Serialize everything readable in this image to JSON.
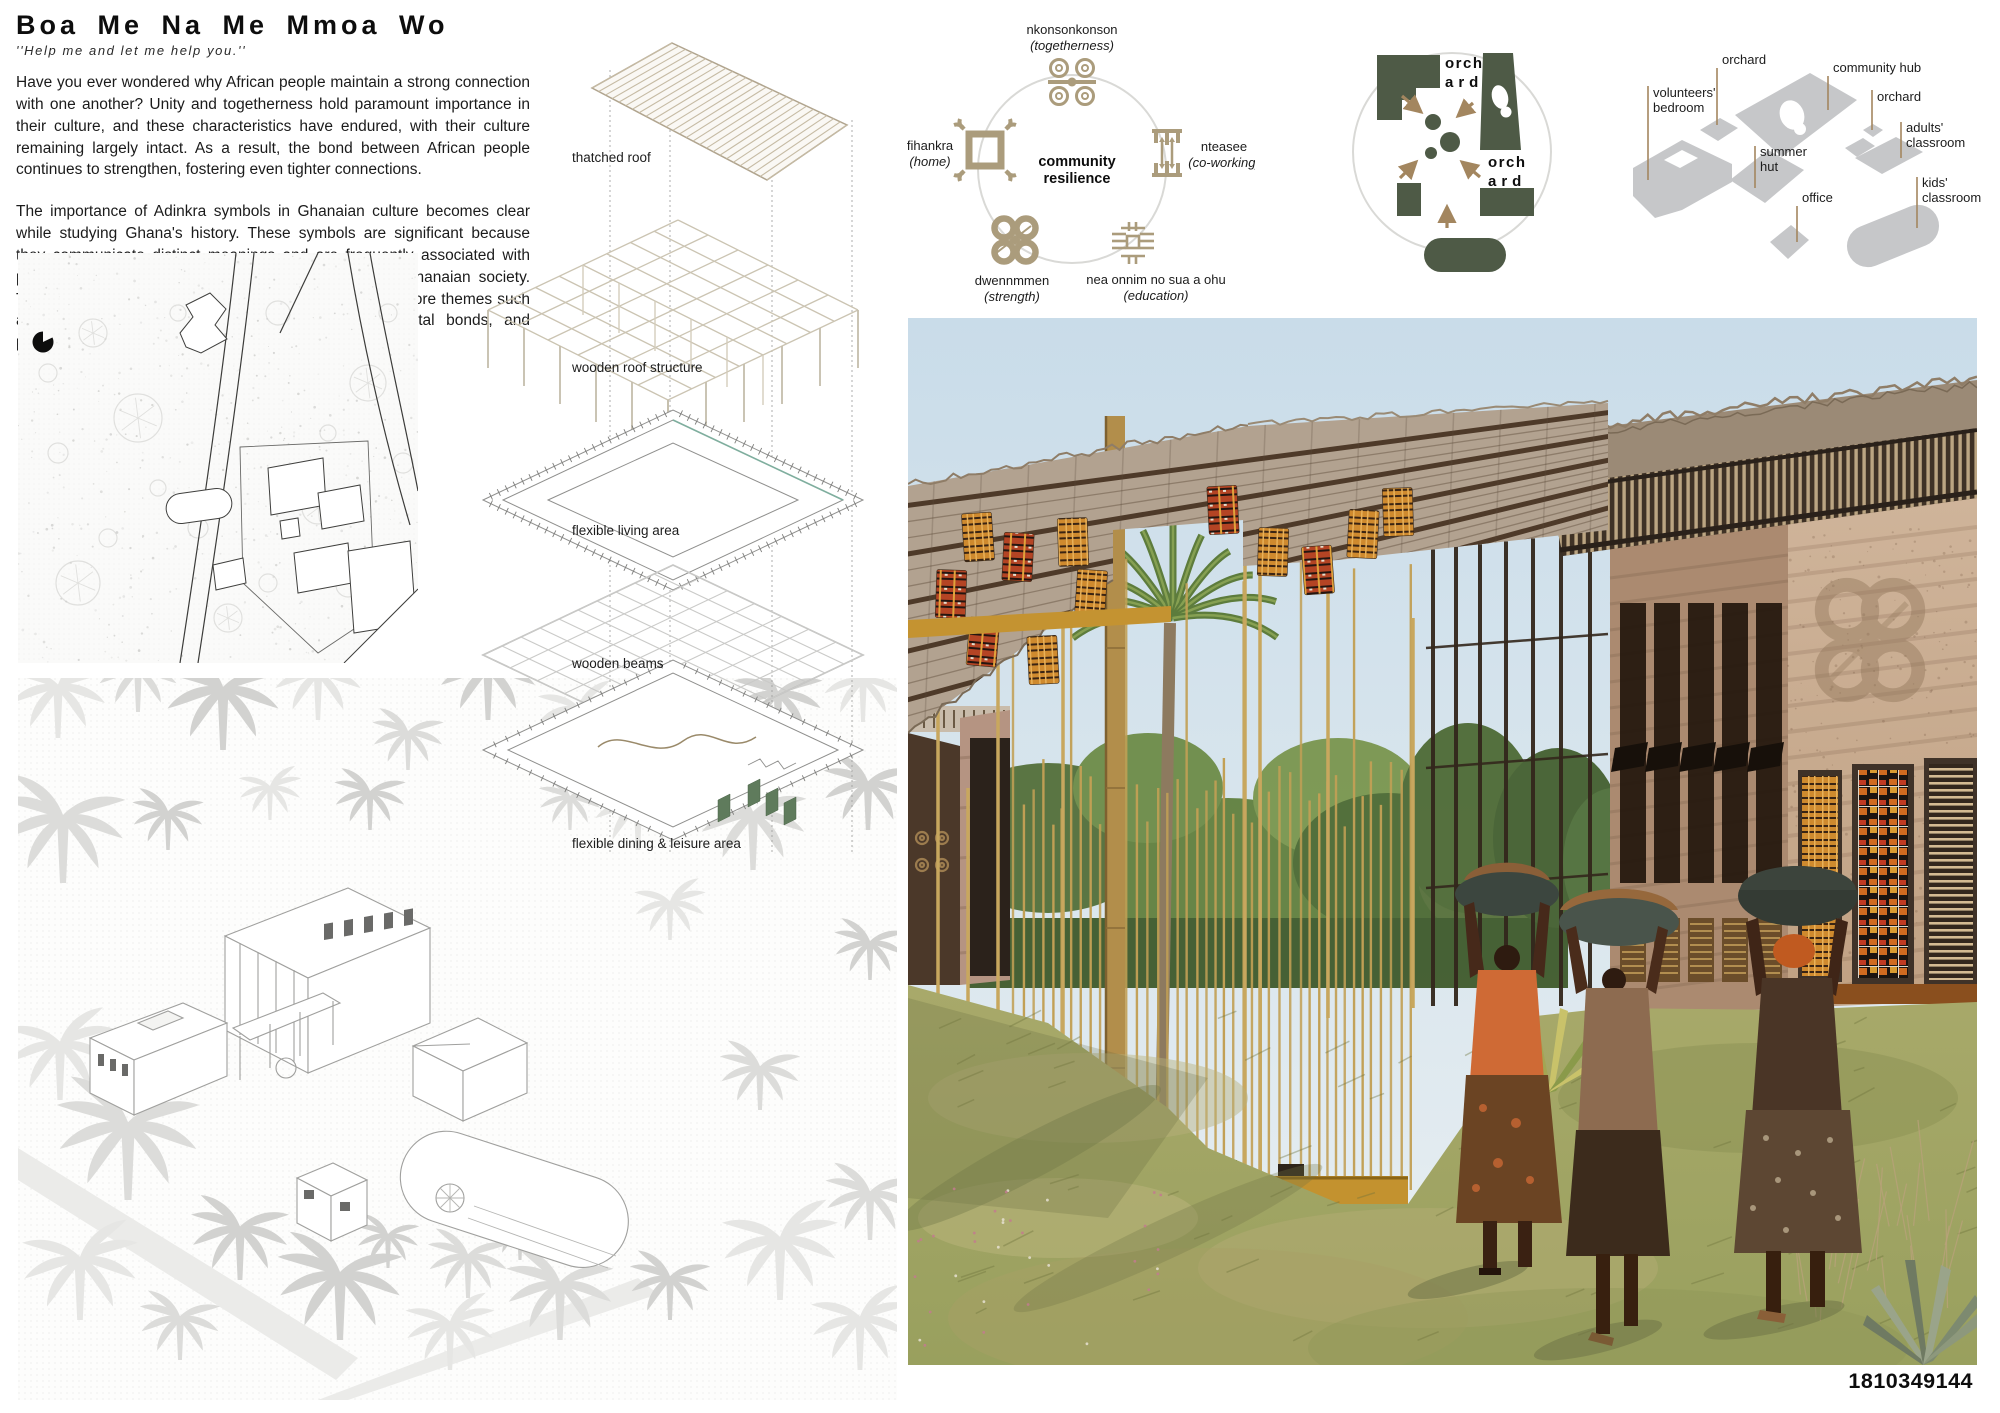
{
  "header": {
    "title": "Boa Me Na Me Mmoa Wo",
    "subtitle": "''Help me and let me help you.''",
    "para1": "Have you ever wondered why African people maintain a strong connection with one another? Unity and togetherness hold paramount importance in their culture, and these characteristics have endured, with their culture remaining largely intact. As a result, the bond between African people continues to strengthen, fostering even tighter connections.",
    "para2": "The importance of Adinkra symbols in Ghanaian culture becomes clear while studying Ghana's history. These symbols are significant because they communicate distinct meanings and are frequently associated with proverbs or idioms. They are extremely important in Ghanaian society. These symbols were used in the designed project to explore themes such as harmonious coexistence, establishing strong societal bonds, and promoting borderless interactions."
  },
  "exploded": {
    "label_thatched_roof": "thatched roof",
    "label_roof_structure": "wooden roof structure",
    "label_living": "flexible living area",
    "label_beams": "wooden beams",
    "label_dining": "flexible dining & leisure area"
  },
  "adinkra": {
    "center_line1": "community",
    "center_line2": "resilience",
    "nkonsonkonson_name": "nkonsonkonson",
    "nkonsonkonson_meaning": "(togetherness)",
    "fihankra_name": "fihankra",
    "fihankra_meaning": "(home)",
    "nteasee_name": "nteasee",
    "nteasee_meaning": "(co-working)",
    "dwennmmen_name": "dwennmmen",
    "dwennmmen_meaning": "(strength)",
    "education_name": "nea onnim no sua a ohu",
    "education_meaning": "(education)"
  },
  "massing": {
    "orchard_top_line1": "orch",
    "orchard_top_line2": "ard",
    "orchard_right_line1": "orch",
    "orchard_right_line2": "ard"
  },
  "site_diagram": {
    "orchard_left": "orchard",
    "community_hub": "community hub",
    "volunteers_line1": "volunteers'",
    "volunteers_line2": "bedroom",
    "orchard_right": "orchard",
    "adults_line1": "adults'",
    "adults_line2": "classroom",
    "summer_line1": "summer",
    "summer_line2": "hut",
    "office": "office",
    "kids_line1": "kids'",
    "kids_line2": "classroom"
  },
  "footer": {
    "board_id": "1810349144"
  },
  "colors": {
    "adinkra_tan": "#ab9c7c",
    "diagram_green": "#4e5a46",
    "leader_tan": "#a3865f",
    "diagram_gray": "#c6c7c9"
  }
}
